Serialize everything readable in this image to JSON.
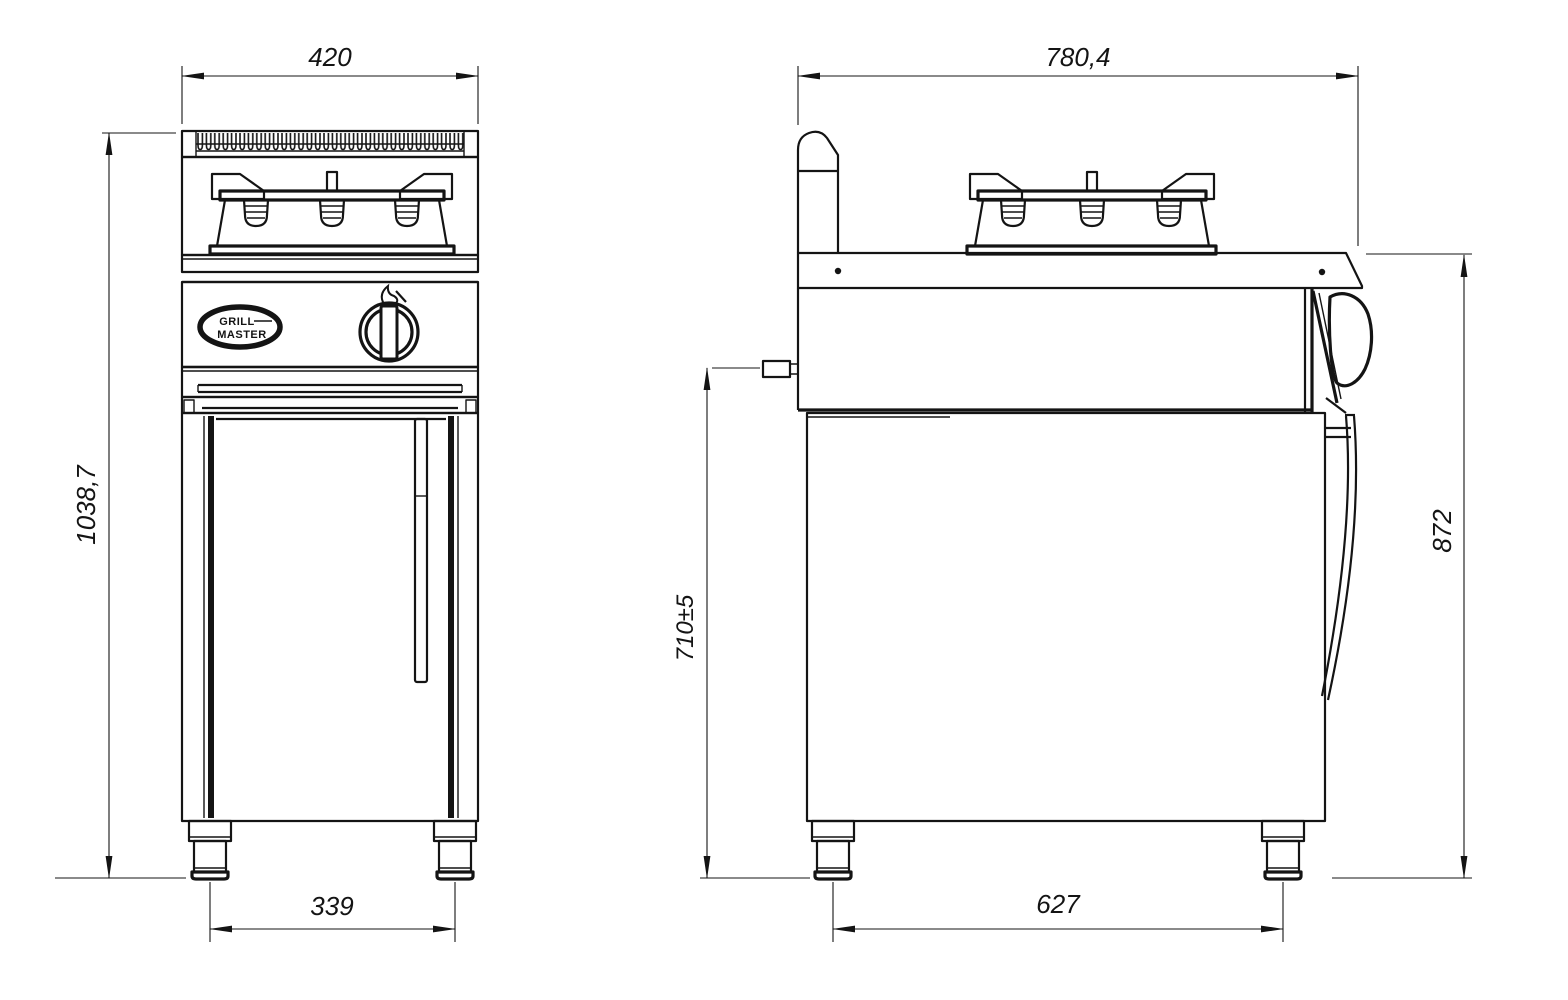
{
  "drawing": {
    "colors": {
      "line": "#141414",
      "background": "#ffffff"
    },
    "front_view": {
      "dim_overall_width": "420",
      "dim_overall_height": "1038,7",
      "dim_leg_span": "339",
      "logo": {
        "line1": "GRILL",
        "line2": "MASTER"
      }
    },
    "side_view": {
      "dim_overall_depth": "780,4",
      "dim_gas_inlet_height": "710±5",
      "dim_worktop_height": "872",
      "dim_leg_span": "627"
    }
  }
}
